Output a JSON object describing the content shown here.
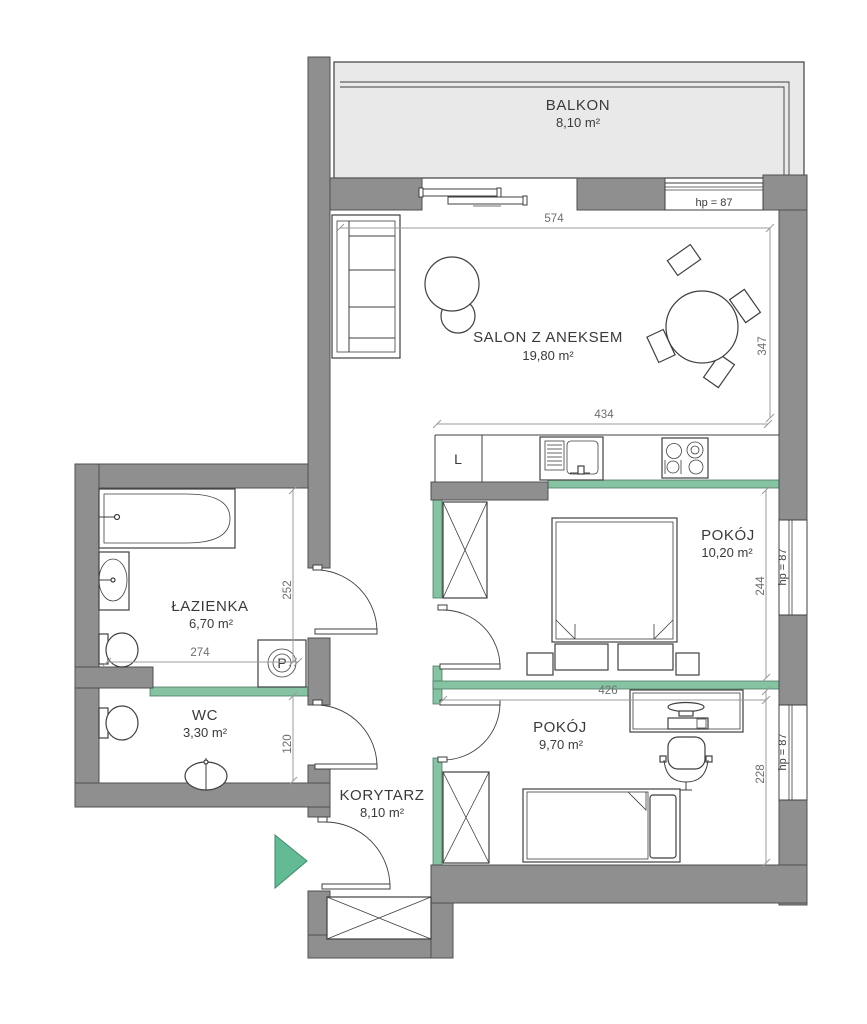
{
  "plan": {
    "rooms": [
      {
        "name": "BALKON",
        "area": "8,10 m²"
      },
      {
        "name": "SALON Z ANEKSEM",
        "area": "19,80 m²"
      },
      {
        "name": "ŁAZIENKA",
        "area": "6,70 m²"
      },
      {
        "name": "WC",
        "area": "3,30 m²"
      },
      {
        "name": "KORYTARZ",
        "area": "8,10 m²"
      },
      {
        "name": "POKÓJ",
        "area": "10,20 m²"
      },
      {
        "name": "POKÓJ",
        "area": "9,70 m²"
      }
    ],
    "dimensions": {
      "salon_width": "574",
      "salon_depth": "347",
      "kitchen_width": "434",
      "bedroom1_depth": "244",
      "bedroom2_width": "426",
      "bedroom2_depth": "228",
      "bathroom_width": "274",
      "bathroom_depth": "252",
      "wc_depth": "120"
    },
    "window_sill_label": "hp = 87",
    "appliance_labels": {
      "fridge": "L",
      "washing_machine": "P"
    },
    "colors": {
      "wall": "#8f8f8f",
      "accent_wall": "#85c3a3",
      "balcony_floor": "#e9e9e9",
      "entrance_arrow": "#63bb95",
      "dim_text": "#6e6e6e"
    }
  }
}
